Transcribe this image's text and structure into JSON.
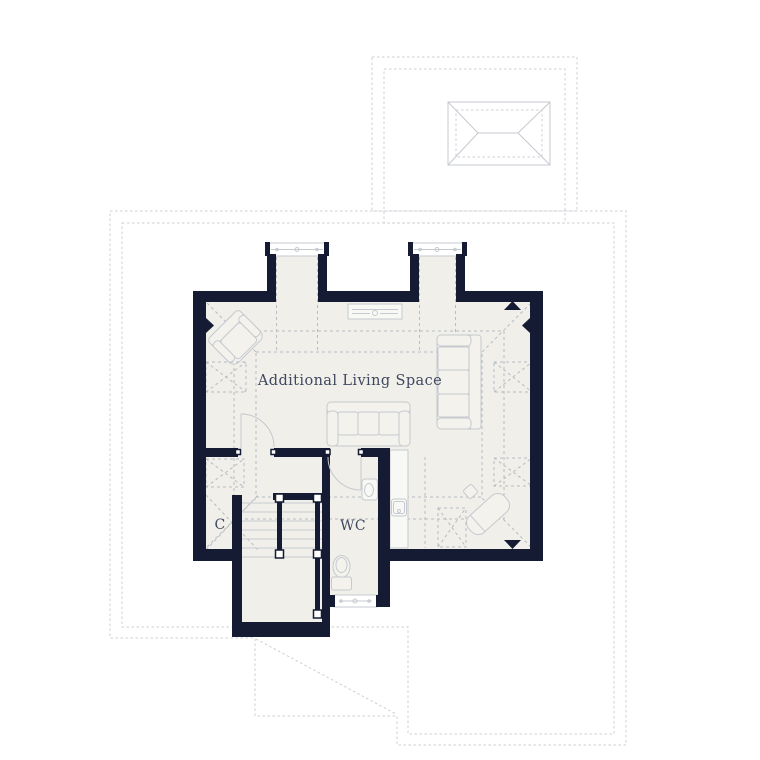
{
  "page": {
    "background": "#ffffff"
  },
  "rooms": [
    {
      "name": "Additional Living Space"
    },
    {
      "name": "WC"
    },
    {
      "name": "C"
    }
  ],
  "colors": {
    "wall": "#141b33",
    "floor": "#f0efe9",
    "dash": "#b7bbc5",
    "roof_dash": "#cdcfd7",
    "outline": "#c6c9cf",
    "furniture_fill": "#f3f2ed",
    "tread": "#c9cdd4",
    "text": "#3e4860"
  }
}
